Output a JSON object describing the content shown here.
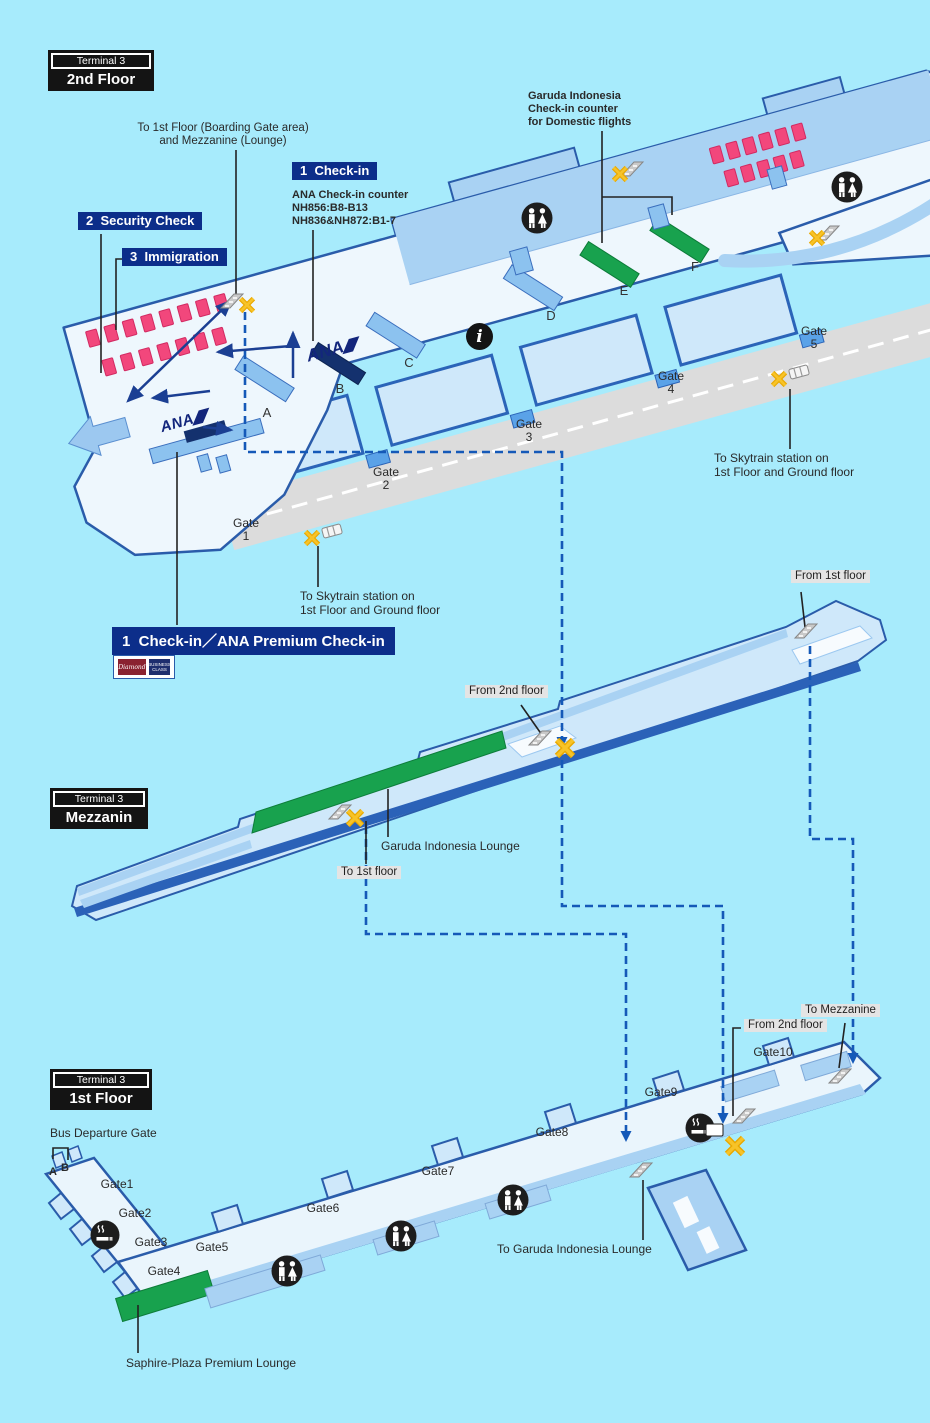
{
  "colors": {
    "background": "#a7ebfc",
    "navy_label": "#0c2e8a",
    "route_blue": "#1559b8",
    "lounge_green": "#18a24e",
    "seat_pink": "#f2477c",
    "road_gray": "#dcdcdc",
    "building_edge": "#2a5caa"
  },
  "second_floor": {
    "badge_terminal": "Terminal 3",
    "badge_floor": "2nd Floor",
    "note_line1": "To 1st Floor (Boarding Gate area)",
    "note_line2": "and Mezzanine (Lounge)",
    "checkin_box": "1  Check-in",
    "ana_counter_line1": "ANA Check-in counter",
    "ana_counter_line2": "NH856:B8-B13",
    "ana_counter_line3": "NH836&NH872:B1-7",
    "security_box": "2  Security Check",
    "immigration_box": "3  Immigration",
    "garuda_line1": "Garuda Indonesia",
    "garuda_line2": "Check-in counter",
    "garuda_line3": "for Domestic flights",
    "counters": [
      "A",
      "B",
      "C",
      "D",
      "E",
      "F"
    ],
    "gate_word": "Gate",
    "gates": [
      "1",
      "2",
      "3",
      "4",
      "5"
    ],
    "skytrain_line1": "To Skytrain station on",
    "skytrain_line2": "1st Floor and Ground floor",
    "premium_banner": "1  Check-in／ANA Premium Check-in",
    "ana_logo": "ANA",
    "diamond_chip": "Diamond",
    "business_chip": "BUSINESS CLASS"
  },
  "mezzanine": {
    "badge_terminal": "Terminal 3",
    "badge_floor": "Mezzanin",
    "from_first": "From 1st floor",
    "from_second": "From 2nd floor",
    "lounge": "Garuda Indonesia Lounge",
    "to_first": "To 1st floor"
  },
  "first_floor": {
    "badge_terminal": "Terminal 3",
    "badge_floor": "1st Floor",
    "bus_gate": "Bus Departure Gate",
    "bus_a": "A",
    "bus_b": "B",
    "gates": [
      "Gate1",
      "Gate2",
      "Gate3",
      "Gate4",
      "Gate5",
      "Gate6",
      "Gate7",
      "Gate8",
      "Gate9",
      "Gate10"
    ],
    "to_mezzanine": "To Mezzanine",
    "from_second": "From 2nd floor",
    "to_garuda_lounge": "To Garuda Indonesia Lounge",
    "saphire": "Saphire-Plaza Premium Lounge"
  },
  "icons": {
    "info_glyph": "i"
  }
}
